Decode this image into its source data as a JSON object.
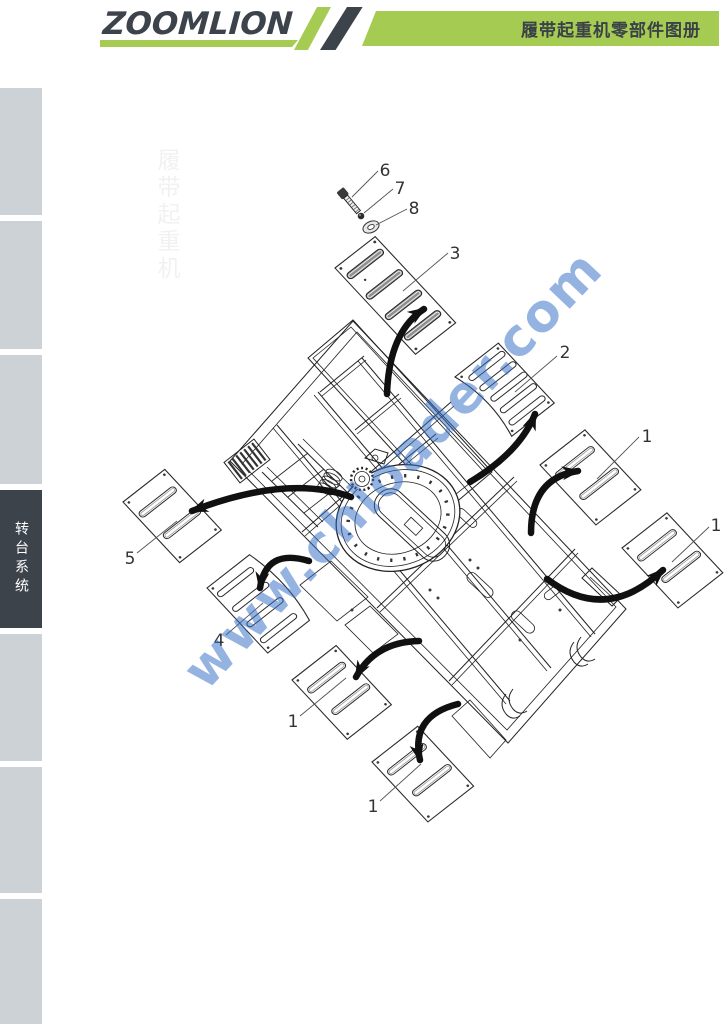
{
  "header": {
    "logo": "ZOOMLION",
    "title": "履带起重机零部件图册",
    "brand_green": "#a6cb52",
    "brand_dark": "#3d434b"
  },
  "sidebar": {
    "tab_count": 7,
    "active_index": 4,
    "active_label": "转台系统",
    "inactive_color": "#cdd2d6",
    "active_color": "#3d434b"
  },
  "diagram": {
    "watermark": "www.chloader.com",
    "watermark_color": "#346ec6",
    "faint_label": "履带起重机",
    "callouts": {
      "c6": "6",
      "c7": "7",
      "c8": "8",
      "c3": "3",
      "c2": "2",
      "c1a": "1",
      "c1b": "1",
      "c5": "5",
      "c4": "4",
      "c1c": "1",
      "c1d": "1"
    }
  }
}
